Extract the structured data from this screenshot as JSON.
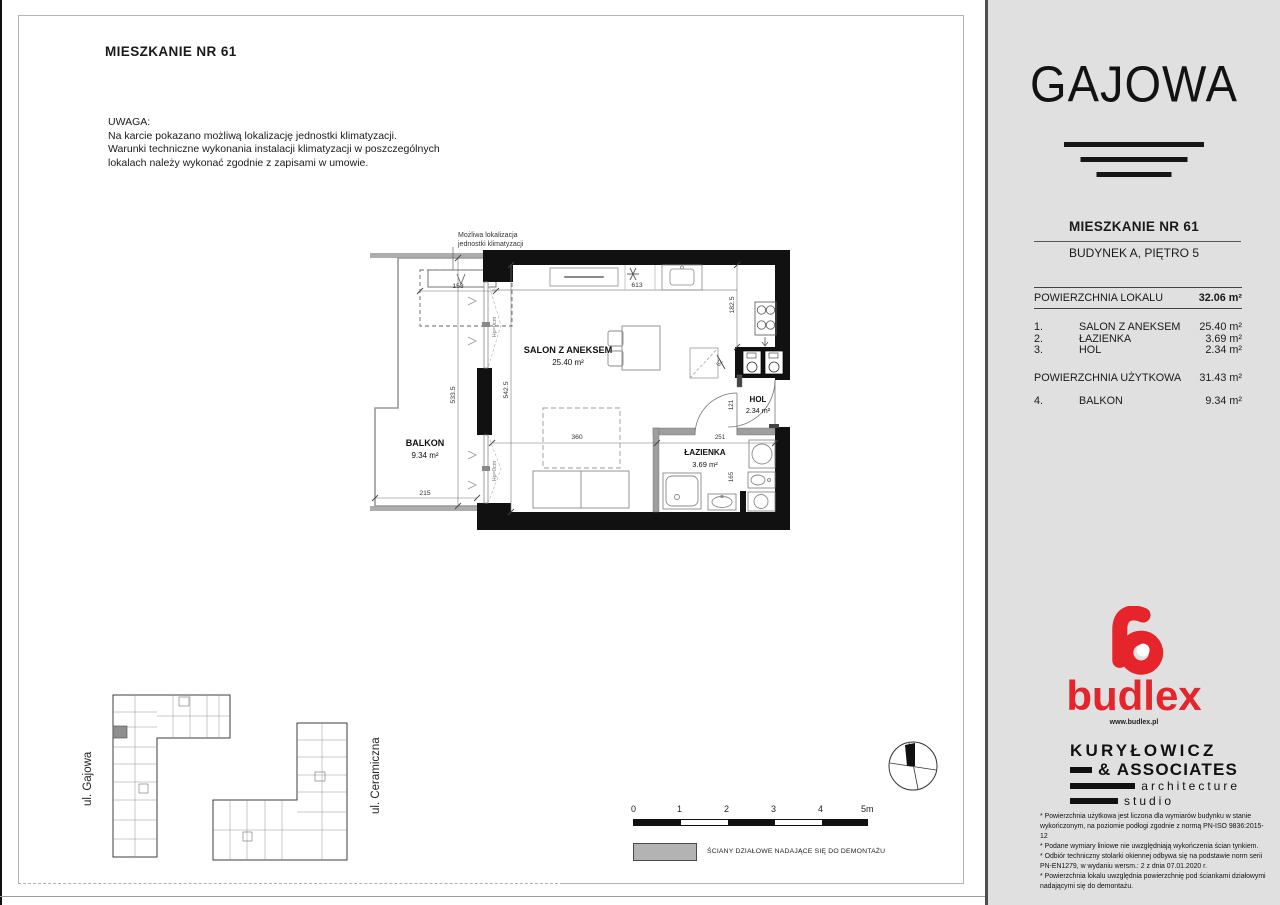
{
  "page": {
    "title": "MIESZKANIE NR 61",
    "note_heading": "UWAGA:",
    "note_line1": "Na karcie pokazano możliwą lokalizację jednostki klimatyzacji.",
    "note_line2": "Warunki techniczne wykonania instalacji klimatyzacji w poszczególnych",
    "note_line3": "lokalach należy wykonać zgodnie z zapisami w umowie."
  },
  "floor_plan": {
    "ac_note_line1": "Możliwa lokalizacja",
    "ac_note_line2": "jednostki klimatyzacji",
    "salon_name": "SALON Z ANEKSEM",
    "salon_area": "25.40 m²",
    "balkon_name": "BALKON",
    "balkon_area": "9.34 m²",
    "hol_name": "HOL",
    "hol_area": "2.34 m²",
    "lazienka_name": "ŁAZIENKA",
    "lazienka_area": "3.69 m²",
    "window_note_1": "Hp=0cm",
    "window_note_2": "Hp=0cm",
    "dims": {
      "ac_width": "158",
      "balcony_width": "215",
      "balcony_length": "533.5",
      "salon_length": "542.5",
      "salon_width": "360",
      "kitchen_run": "613",
      "kitchen_depth": "182.5",
      "shaft": "62",
      "hol_width": "121",
      "bath_width": "251",
      "bath_niche": "165"
    }
  },
  "site_plan": {
    "street_left": "ul. Gajowa",
    "street_right": "ul. Ceramiczna"
  },
  "scale_bar": {
    "t0": "0",
    "t1": "1",
    "t2": "2",
    "t3": "3",
    "t4": "4",
    "t5": "5m"
  },
  "legend_label": "ŚCIANY DZIAŁOWE NADAJĄCE SIĘ DO DEMONTAŻU",
  "sidebar": {
    "brand": "GAJOWA",
    "apartment_title": "MIESZKANIE NR 61",
    "building_floor": "BUDYNEK A, PIĘTRO 5",
    "total_label": "POWIERZCHNIA LOKALU",
    "total_value": "32.06 m²",
    "rooms": [
      {
        "no": "1.",
        "name": "SALON Z ANEKSEM",
        "area": "25.40 m²"
      },
      {
        "no": "2.",
        "name": "ŁAZIENKA",
        "area": "3.69 m²"
      },
      {
        "no": "3.",
        "name": "HOL",
        "area": "2.34 m²"
      }
    ],
    "usable_label": "POWIERZCHNIA UŻYTKOWA",
    "usable_value": "31.43 m²",
    "balcony": {
      "no": "4.",
      "name": "BALKON",
      "area": "9.34 m²"
    },
    "budlex_name": "budlex",
    "budlex_url": "www.budlex.pl",
    "architect": {
      "l1": "KURYŁOWICZ",
      "l2": "& ASSOCIATES",
      "l3": "architecture",
      "l4": "studio"
    },
    "footnotes": [
      "* Powierzchnia użytkowa jest liczona dla wymiarów budynku w stanie wykończonym, na poziomie podłogi zgodnie z normą PN-ISO 9836:2015-12",
      "* Podane wymiary liniowe nie uwzględniają wykończenia ścian tynkiem.",
      "* Odbiór techniczny stolarki okiennej odbywa się na podstawie norm serii PN-EN1279, w wydaniu wersm.: 2 z dnia 07.01.2020 r.",
      "* Powierzchnia lokalu uwzględnia powierzchnię pod ściankami działowymi nadającymi się do demontażu."
    ]
  },
  "colors": {
    "accent_red": "#e5252b",
    "wall_black": "#111111",
    "partition_gray": "#9e9e9e"
  }
}
